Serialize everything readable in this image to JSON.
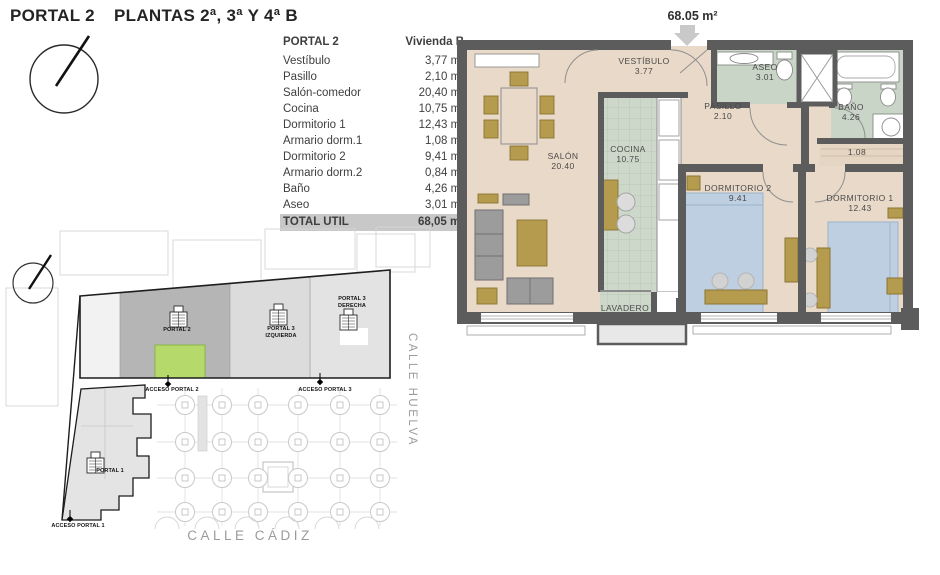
{
  "header": {
    "portal": "PORTAL 2",
    "plantas": "PLANTAS 2ª, 3ª Y 4ª B"
  },
  "area_table": {
    "col_room": "PORTAL 2",
    "col_value": "Vivienda B",
    "rows": [
      {
        "label": "Vestíbulo",
        "value": "3,77 m²"
      },
      {
        "label": "Pasillo",
        "value": "2,10 m²"
      },
      {
        "label": "Salón-comedor",
        "value": "20,40 m²"
      },
      {
        "label": "Cocina",
        "value": "10,75 m²"
      },
      {
        "label": "Dormitorio 1",
        "value": "12,43 m²"
      },
      {
        "label": "Armario dorm.1",
        "value": "1,08 m²"
      },
      {
        "label": "Dormitorio 2",
        "value": "9,41 m²"
      },
      {
        "label": "Armario dorm.2",
        "value": "0,84 m²"
      },
      {
        "label": "Baño",
        "value": "4,26 m²"
      },
      {
        "label": "Aseo",
        "value": "3,01 m²"
      }
    ],
    "total": {
      "label": "TOTAL UTIL",
      "value": "68,05 m²"
    }
  },
  "floor_plan": {
    "total_area": "68.05 m²",
    "rooms": {
      "vestibulo": {
        "name": "VESTÍBULO",
        "area": "3.77"
      },
      "pasillo": {
        "name": "PASILLO",
        "area": "2.10"
      },
      "salon": {
        "name": "SALÓN",
        "area": "20.40"
      },
      "cocina": {
        "name": "COCINA",
        "area": "10.75"
      },
      "aseo": {
        "name": "ASEO",
        "area": "3.01"
      },
      "bano": {
        "name": "BAÑO",
        "area": "4.26"
      },
      "dormitorio2": {
        "name": "DORMITORIO 2",
        "area": "9.41"
      },
      "dormitorio1": {
        "name": "DORMITORIO 1",
        "area": "12.43"
      },
      "lavadero": {
        "name": "LAVADERO"
      },
      "armario_dorm1": {
        "area": "1.08"
      }
    }
  },
  "site_plan": {
    "portal2": "PORTAL 2",
    "portal3_izquierda": "PORTAL 3 IZQUIERDA",
    "portal3_derecha": "PORTAL 3 DERECHA",
    "portal1": "PORTAL 1",
    "acceso_portal1": "ACCESO PORTAL 1",
    "acceso_portal2": "ACCESO PORTAL 2",
    "acceso_portal3": "ACCESO PORTAL 3",
    "calle_huelva": "CALLE HUELVA",
    "calle_cadiz": "CALLE CÁDIZ",
    "highlight_color": "#b5d96a"
  }
}
